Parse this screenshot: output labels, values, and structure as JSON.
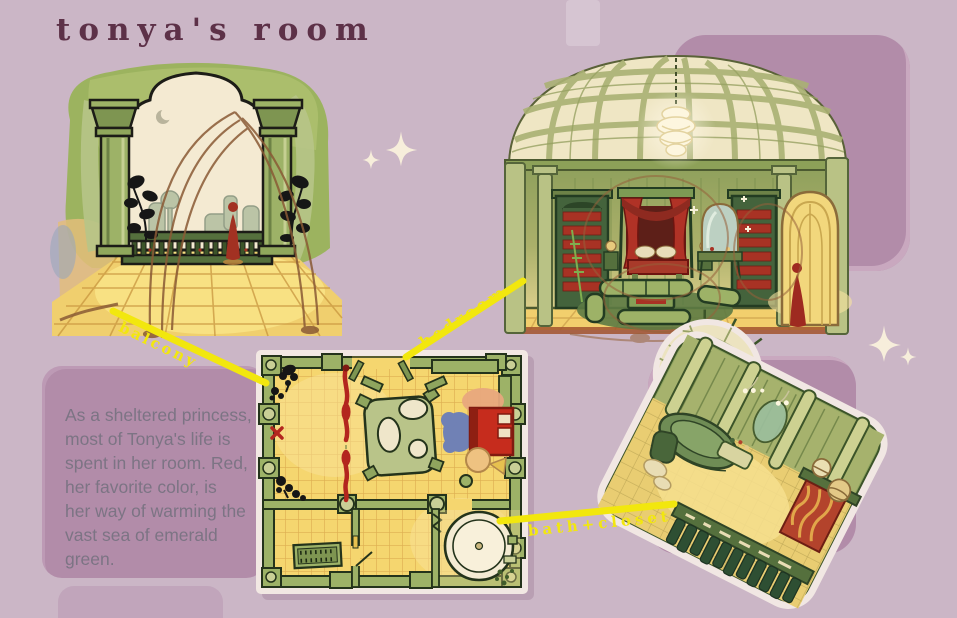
{
  "page": {
    "title": "tonya's room",
    "background_color": "#cbb6c6",
    "panel_color": "#b28ca9",
    "accent_yellow": "#f2e70e",
    "title_color": "#5d3148",
    "body_text_color": "#7c7484",
    "sparkle_color": "#f7eedb"
  },
  "description": {
    "text": "As a sheltered princess,\nmost of Tonya's life is\nspent in her room. Red,\nher favorite color, is\nher way of warming the\nvast sea of emerald green."
  },
  "callouts": {
    "balcony": {
      "label": "balcony"
    },
    "bedroom": {
      "label": "bedroom"
    },
    "bath_closet": {
      "label": "bath+closet"
    }
  },
  "art_palette": {
    "emerald_green": "#55703d",
    "leaf_green": "#9db267",
    "cream": "#f2e8d0",
    "floor_yellow": "#f0cf6e",
    "accent_red": "#a83224",
    "sketch_brown": "#8a5a35"
  }
}
